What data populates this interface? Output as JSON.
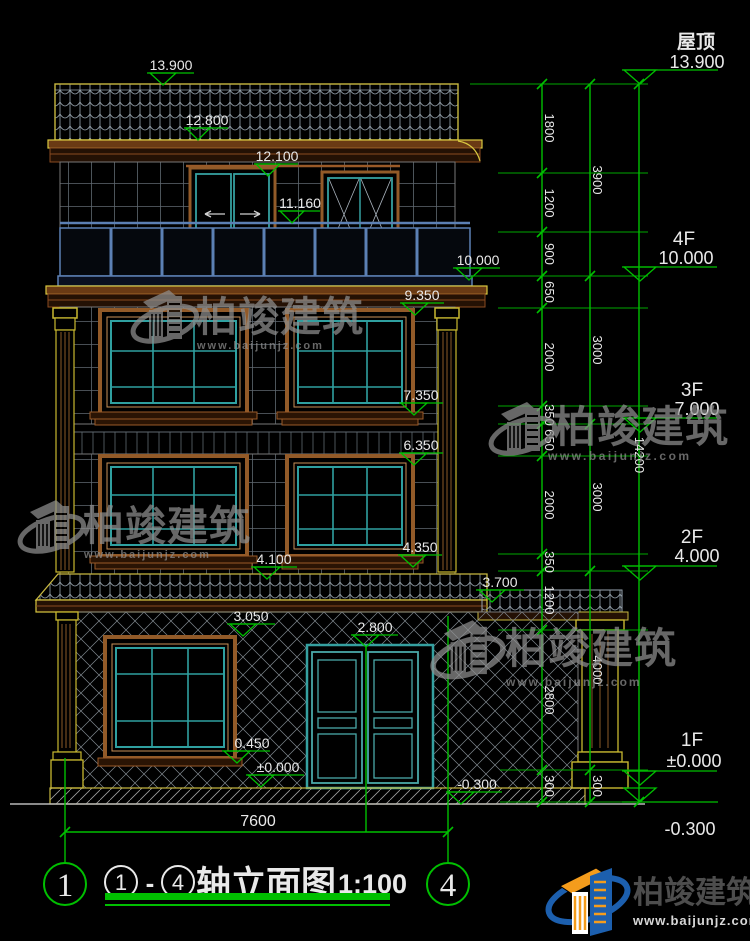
{
  "elevations": [
    "13.900",
    "12.800",
    "12.100",
    "11.160",
    "10.000",
    "9.350",
    "7.350",
    "6.350",
    "4.350",
    "4.100",
    "3.700",
    "3.050",
    "2.800",
    "0.450",
    "±0.000",
    "-0.300"
  ],
  "floors": {
    "roof_label": "屋顶",
    "roof_value": "13.900",
    "f4_label": "4F",
    "f4_value": "10.000",
    "f3_label": "3F",
    "f3_value": "7.000",
    "f2_label": "2F",
    "f2_value": "4.000",
    "f1_label": "1F",
    "f1_value": "±0.000",
    "base_value": "-0.300"
  },
  "dims": {
    "inner": [
      "1800",
      "1200",
      "900",
      "650",
      "2000",
      "350",
      "650",
      "2000",
      "350",
      "1200",
      "2800",
      "300"
    ],
    "floor": [
      "3900",
      "3000",
      "3000",
      "4000",
      "300"
    ],
    "total": "14200",
    "width": "7600"
  },
  "title_block": {
    "axis_left": "1",
    "axis_right": "4",
    "circle_start": "1",
    "separator": "-",
    "circle_end": "4",
    "name": "轴立面图",
    "scale": "1:100"
  },
  "watermark": {
    "brand": "柏竣建筑",
    "site": "www.baijunjz.com"
  },
  "footer": {
    "brand": "柏竣建筑",
    "site": "www.baijunjz.com"
  },
  "colors": {
    "dimension_green": "#00bf00",
    "frame_brown": "#925a28",
    "window_teal": "#2fa0a0",
    "column_yellow": "#c8b830",
    "balcony_blue": "#5c80b4",
    "logo_blue": "#1c5fae",
    "logo_orange": "#f49c1c"
  }
}
